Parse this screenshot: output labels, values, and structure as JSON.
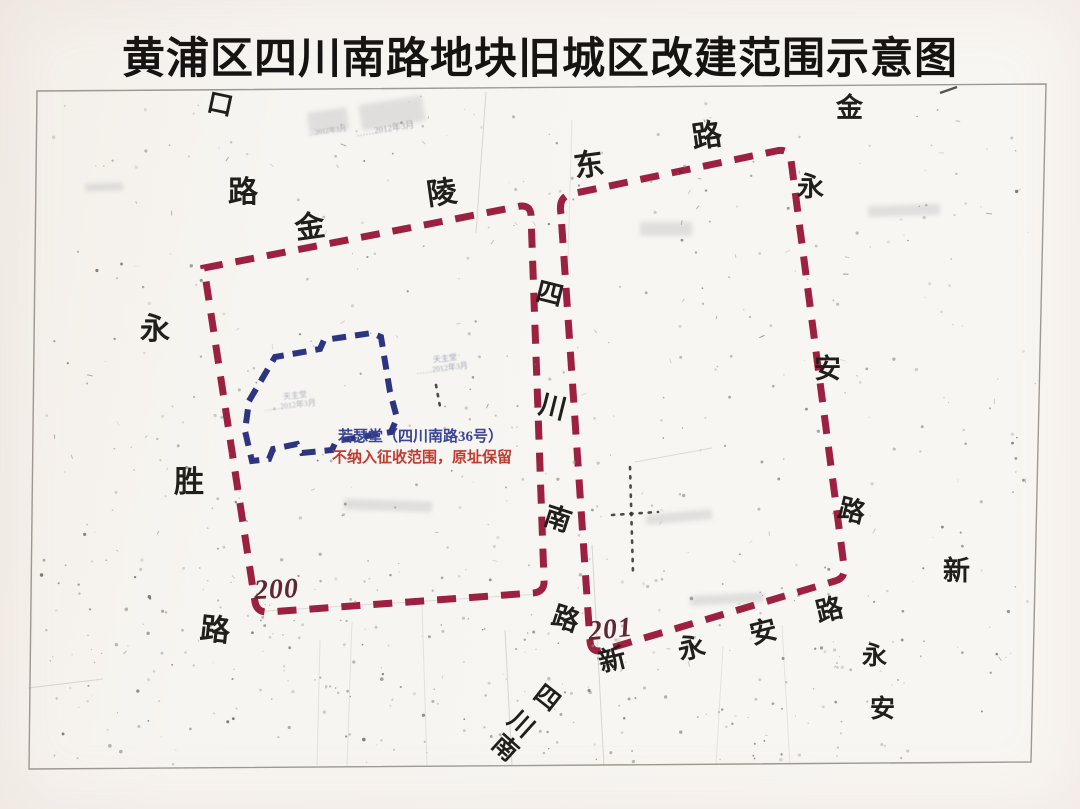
{
  "title": "黄浦区四川南路地块旧城区改建范围示意图",
  "regions": [
    {
      "id": "200",
      "label": "200"
    },
    {
      "id": "201",
      "label": "201"
    }
  ],
  "church": {
    "name_line": "若瑟堂（四川南路36号）",
    "note_line": "不纳入征收范围，原址保留"
  },
  "streets": [
    "金陵东路",
    "四川南路",
    "永胜路",
    "永安路",
    "新永安路"
  ],
  "map_labels": [
    {
      "text": "口",
      "x": 207,
      "y": 92,
      "size": 26,
      "rot": 12
    },
    {
      "text": "路",
      "x": 228,
      "y": 178,
      "size": 30,
      "rot": 0
    },
    {
      "text": "金",
      "x": 295,
      "y": 213,
      "size": 30,
      "rot": -8
    },
    {
      "text": "陵",
      "x": 427,
      "y": 179,
      "size": 30,
      "rot": -8
    },
    {
      "text": "东",
      "x": 574,
      "y": 151,
      "size": 30,
      "rot": -8
    },
    {
      "text": "路",
      "x": 692,
      "y": 122,
      "size": 30,
      "rot": -8
    },
    {
      "text": "金",
      "x": 836,
      "y": 95,
      "size": 27,
      "rot": 0
    },
    {
      "text": "永",
      "x": 797,
      "y": 174,
      "size": 27,
      "rot": 0
    },
    {
      "text": "安",
      "x": 814,
      "y": 356,
      "size": 27,
      "rot": 0
    },
    {
      "text": "路",
      "x": 838,
      "y": 498,
      "size": 27,
      "rot": 14
    },
    {
      "text": "新",
      "x": 943,
      "y": 558,
      "size": 27,
      "rot": 0
    },
    {
      "text": "永",
      "x": 862,
      "y": 644,
      "size": 25,
      "rot": 0
    },
    {
      "text": "安",
      "x": 870,
      "y": 697,
      "size": 25,
      "rot": 0
    },
    {
      "text": "四",
      "x": 536,
      "y": 281,
      "size": 27,
      "rot": 14
    },
    {
      "text": "川",
      "x": 539,
      "y": 394,
      "size": 27,
      "rot": 14
    },
    {
      "text": "南",
      "x": 544,
      "y": 506,
      "size": 27,
      "rot": 18
    },
    {
      "text": "路",
      "x": 552,
      "y": 606,
      "size": 27,
      "rot": 18
    },
    {
      "text": "新",
      "x": 599,
      "y": 647,
      "size": 27,
      "rot": -14
    },
    {
      "text": "永",
      "x": 678,
      "y": 635,
      "size": 27,
      "rot": -14
    },
    {
      "text": "安",
      "x": 750,
      "y": 619,
      "size": 27,
      "rot": -14
    },
    {
      "text": "路",
      "x": 816,
      "y": 597,
      "size": 27,
      "rot": -14
    },
    {
      "text": "四",
      "x": 534,
      "y": 686,
      "size": 25,
      "rot": 38
    },
    {
      "text": "川",
      "x": 508,
      "y": 712,
      "size": 25,
      "rot": 42
    },
    {
      "text": "南",
      "x": 492,
      "y": 736,
      "size": 25,
      "rot": 42
    },
    {
      "text": "永",
      "x": 140,
      "y": 315,
      "size": 30,
      "rot": 0
    },
    {
      "text": "胜",
      "x": 174,
      "y": 468,
      "size": 30,
      "rot": 0
    },
    {
      "text": "路",
      "x": 200,
      "y": 616,
      "size": 30,
      "rot": 6
    }
  ],
  "faint_texts": [
    {
      "text": "天主堂",
      "x": 433,
      "y": 354,
      "size": 8,
      "rot": -7,
      "color": "#8a93aa"
    },
    {
      "text": "……2012年3月",
      "x": 416,
      "y": 364,
      "size": 8,
      "rot": -7,
      "color": "#8a93aa"
    },
    {
      "text": "天主堂",
      "x": 283,
      "y": 391,
      "size": 8,
      "rot": -7,
      "color": "#9aa0b2"
    },
    {
      "text": "……2012年3月",
      "x": 264,
      "y": 401,
      "size": 8,
      "rot": -7,
      "color": "#9aa0b2"
    },
    {
      "text": "……2012年3月",
      "x": 356,
      "y": 124,
      "size": 9,
      "rot": -9,
      "color": "#8d9099"
    },
    {
      "text": "…2012年3月",
      "x": 308,
      "y": 127,
      "size": 7,
      "rot": -8,
      "color": "#9b9da4"
    }
  ],
  "colors": {
    "boundary_red": "#9c2140",
    "church_blue": "#2d3480",
    "note_blue": "#3a4394",
    "note_red": "#c23b30",
    "label_dark_red": "#5e2732",
    "ink": "#211f1c"
  }
}
